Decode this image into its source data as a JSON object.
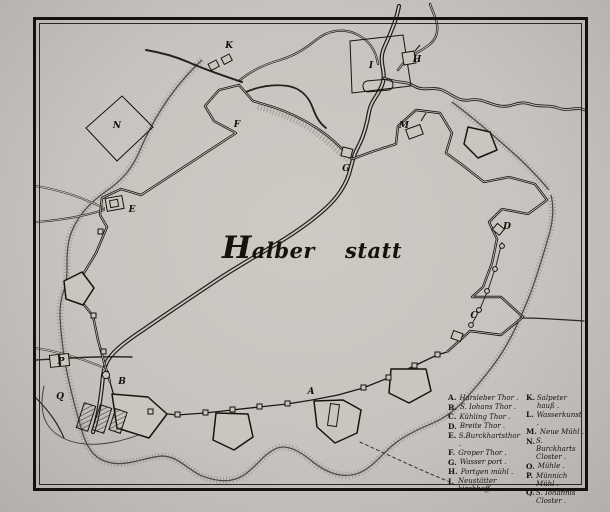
{
  "map": {
    "title": {
      "part1": "Halber",
      "part2": "statt"
    },
    "markers": [
      {
        "letter": "A",
        "x": 311,
        "y": 392
      },
      {
        "letter": "B",
        "x": 122,
        "y": 382
      },
      {
        "letter": "C",
        "x": 474,
        "y": 316
      },
      {
        "letter": "D",
        "x": 507,
        "y": 227
      },
      {
        "letter": "E",
        "x": 132,
        "y": 210
      },
      {
        "letter": "F",
        "x": 237,
        "y": 125
      },
      {
        "letter": "G",
        "x": 346,
        "y": 169
      },
      {
        "letter": "H",
        "x": 417,
        "y": 60
      },
      {
        "letter": "I",
        "x": 371,
        "y": 66
      },
      {
        "letter": "K",
        "x": 229,
        "y": 46
      },
      {
        "letter": "M",
        "x": 404,
        "y": 126
      },
      {
        "letter": "N",
        "x": 117,
        "y": 126
      },
      {
        "letter": "P",
        "x": 61,
        "y": 362
      },
      {
        "letter": "Q",
        "x": 60,
        "y": 397
      }
    ]
  },
  "legend": {
    "columns": [
      {
        "entries": [
          {
            "key": "A.",
            "label": "Harsleber Thor ."
          },
          {
            "key": "B.",
            "label": "S. Iohans Thor ."
          },
          {
            "key": "C.",
            "label": "Kühling Thor ."
          },
          {
            "key": "D.",
            "label": "Breite Thor ."
          },
          {
            "key": "E.",
            "label": "S.Burckhartsthor ."
          },
          {
            "key": "F.",
            "label": "Groper Thor ."
          },
          {
            "key": "G.",
            "label": "Wasser port ."
          },
          {
            "key": "H.",
            "label": "Portgen mühl ."
          },
          {
            "key": "I.",
            "label": "Neustätter kirchhoff ."
          }
        ]
      },
      {
        "entries": [
          {
            "key": "K.",
            "label": "Salpeter hauß ."
          },
          {
            "key": "L.",
            "label": "Wasserkunst ."
          },
          {
            "key": "M.",
            "label": "Neue Mühl ."
          },
          {
            "key": "N.",
            "label": "S. Burckharts Closter ."
          },
          {
            "key": "O.",
            "label": "Mühle ."
          },
          {
            "key": "P.",
            "label": "Münnich Mühl ."
          },
          {
            "key": "Q.",
            "label": "S. Iohannis Closter ."
          }
        ]
      }
    ]
  }
}
